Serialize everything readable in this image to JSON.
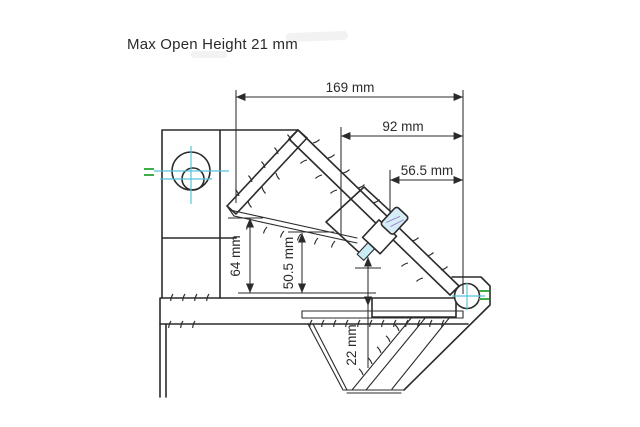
{
  "title": "Max Open Height 21 mm",
  "dimensions": {
    "overall_length": "169 mm",
    "arm_length": "92 mm",
    "bolt_position": "56.5 mm",
    "jaw_height_outer": "64 mm",
    "jaw_height_inner": "50.5 mm",
    "base_offset": "22 mm"
  },
  "colors": {
    "line": "#2b2b2b",
    "section_hatch": "#b14b4b",
    "centerline": "#56c4d8",
    "datum_green": "#3fae4a",
    "bolt_highlight": "#d6edf7",
    "background": "#ffffff"
  }
}
